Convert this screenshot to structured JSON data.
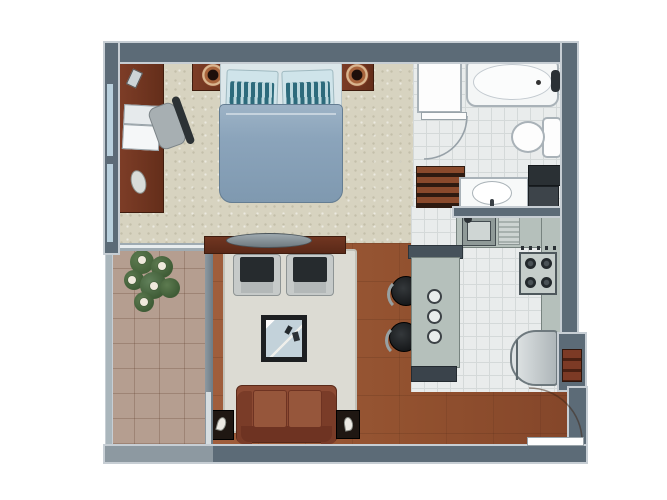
{
  "title": "Studio apartment floor plan (top-down 3D render, no text labels)",
  "colors": {
    "wall": "#5c6b77",
    "wall_light": "#8d99a1",
    "outline": "#c7ced4",
    "carpet": "#d7d3c0",
    "wood": "#92512f",
    "wood_furniture": "#642e1a",
    "tile": "#e9ecec",
    "tile_line": "#d4d9d9",
    "balcony_tile": "#b59e90",
    "counter": "#b5c0bb",
    "counter_edge": "#77837f",
    "duvet": "#8ba4bb",
    "pillow_teal": "#2d6b7c",
    "pillow_base": "#cfe4ea",
    "sheet": "#dce7ea",
    "sofa": "#8c4a33",
    "sofa_dark": "#6e3322",
    "rug": "#dcdbd3",
    "seat_dark": "#262b2e",
    "glass": "#c3d2da",
    "plant_green": "#45623a",
    "window_glass": "#b9d0dd",
    "stool": "#17191b",
    "white_fixture": "#f4f6f6"
  },
  "floorplan": {
    "rooms": [
      {
        "name": "Bedroom",
        "floor": "beige carpet",
        "items": [
          "double bed with blue duvet",
          "two teal striped pillows",
          "dark wood headboard",
          "two round speaker nightstands",
          "wood desk along window wall",
          "laptop",
          "desk chair",
          "phone on desk",
          "built-in closet"
        ]
      },
      {
        "name": "Bathroom",
        "floor": "white tile",
        "items": [
          "bathtub with faucet",
          "toilet with tank",
          "oval washbasin",
          "linen shelf unit",
          "dark laundry/counter unit",
          "swing door with arc"
        ]
      },
      {
        "name": "Kitchen",
        "floor": "light grey tile",
        "items": [
          "stainless sink with drainboard",
          "4-burner gas cooktop with knobs",
          "refrigerator",
          "island breakfast bar with 3 hob knobs",
          "two black bar stools",
          "wall counter"
        ]
      },
      {
        "name": "Living room",
        "floor": "reddish wood",
        "items": [
          "TV console with oval TV",
          "two dark armchairs",
          "light area rug",
          "square glass coffee table with remotes",
          "terracotta sofa",
          "two side tables with small lamps"
        ]
      },
      {
        "name": "Balcony",
        "floor": "terracotta tile grid",
        "items": [
          "potted plant with white flowers",
          "glass railing",
          "sliding glass doors"
        ]
      },
      {
        "name": "Entry",
        "floor": "wood",
        "items": [
          "entry door with swing arc",
          "recessed shoe cabinet in right wall"
        ]
      }
    ],
    "windows": [
      "two window strips on left bedroom wall"
    ],
    "doors": [
      "bathroom swing door",
      "entry swing door bottom-right",
      "balcony sliding panels"
    ]
  }
}
